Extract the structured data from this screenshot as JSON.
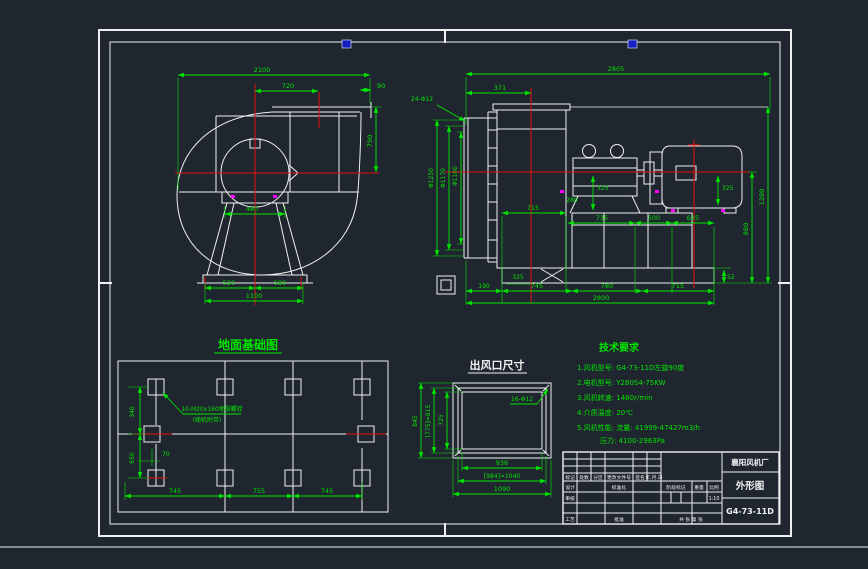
{
  "palette": {
    "background": "#20262f",
    "line_white": "#eef1f1",
    "dimension_green": "#00e400",
    "centerline_red": "#e01212",
    "accent_magenta": "#ff00ff",
    "mark_blue": "#1520c0"
  },
  "front_view": {
    "dims": {
      "total_width": "2100",
      "outlet_width": "720",
      "lip": "90",
      "outlet_height": "790",
      "pedestal_width": "480",
      "base_left": "520",
      "base_right": "580",
      "base_total": "1100"
    }
  },
  "side_view": {
    "callout_inlet_bolts": "24-Φ12",
    "dims": {
      "total_length": "2805",
      "inlet_depth": "371",
      "flange_dia": "Φ1250",
      "bolt_circle_dia": "Φ1170",
      "inlet_dia": "Φ1100",
      "housing_width": "715",
      "span_1": "735",
      "span_2": "500",
      "span_3": "625",
      "bearing_height": "325",
      "motor_height": "325",
      "stand_depth": "280",
      "base_pad": "325",
      "front_offset": "190",
      "base_1": "745",
      "base_2": "780",
      "base_3": "715",
      "base_total": "2800",
      "overall_height": "1280",
      "axis_height": "880",
      "plate_thickness": "52"
    }
  },
  "foundation": {
    "title": "地面基础图",
    "note_line1": "10-M20x160地脚螺栓",
    "note_line2": "(随机附带)",
    "dims": {
      "row_top": "340",
      "row_bottom": "650",
      "edge_offset": "70",
      "col_1": "745",
      "col_2": "755",
      "col_3": "745"
    }
  },
  "outlet": {
    "title": "出风口尺寸",
    "callout_bolts": "16-Φ12",
    "dims": {
      "inner_width": "936",
      "bolt_width": "[984]=1040",
      "outer_width": "1090",
      "inner_height": "725",
      "bolt_height": "[775]=815",
      "outer_height": "845"
    }
  },
  "tech": {
    "title": "技术要求",
    "lines": [
      "1.风机型号: G4-73-11D左旋90度",
      "2.电机型号: Y280S4-75KW",
      "3.风机转速: 1480r/min",
      "4.介质温度: 20℃",
      "5.风机性能: 流量: 41999-47427m3/h",
      "压力: 4100-2963Pa"
    ]
  },
  "title_block": {
    "company": "襄阳风机厂",
    "drawing_title": "外形图",
    "model": "G4-73-11D",
    "scale_value": "1:10",
    "labels": {
      "mark": "标记",
      "qty": "处数",
      "zone": "分区",
      "change_doc": "更改文件号",
      "signature": "签名",
      "date": "年.月.日",
      "design": "设计",
      "standardize": "标准化",
      "stage_mark": "阶段标记",
      "weight": "重量",
      "scale": "比例",
      "review": "审核",
      "craft": "工艺",
      "approve": "批准",
      "sheet_info": "共 张 第 张"
    }
  }
}
